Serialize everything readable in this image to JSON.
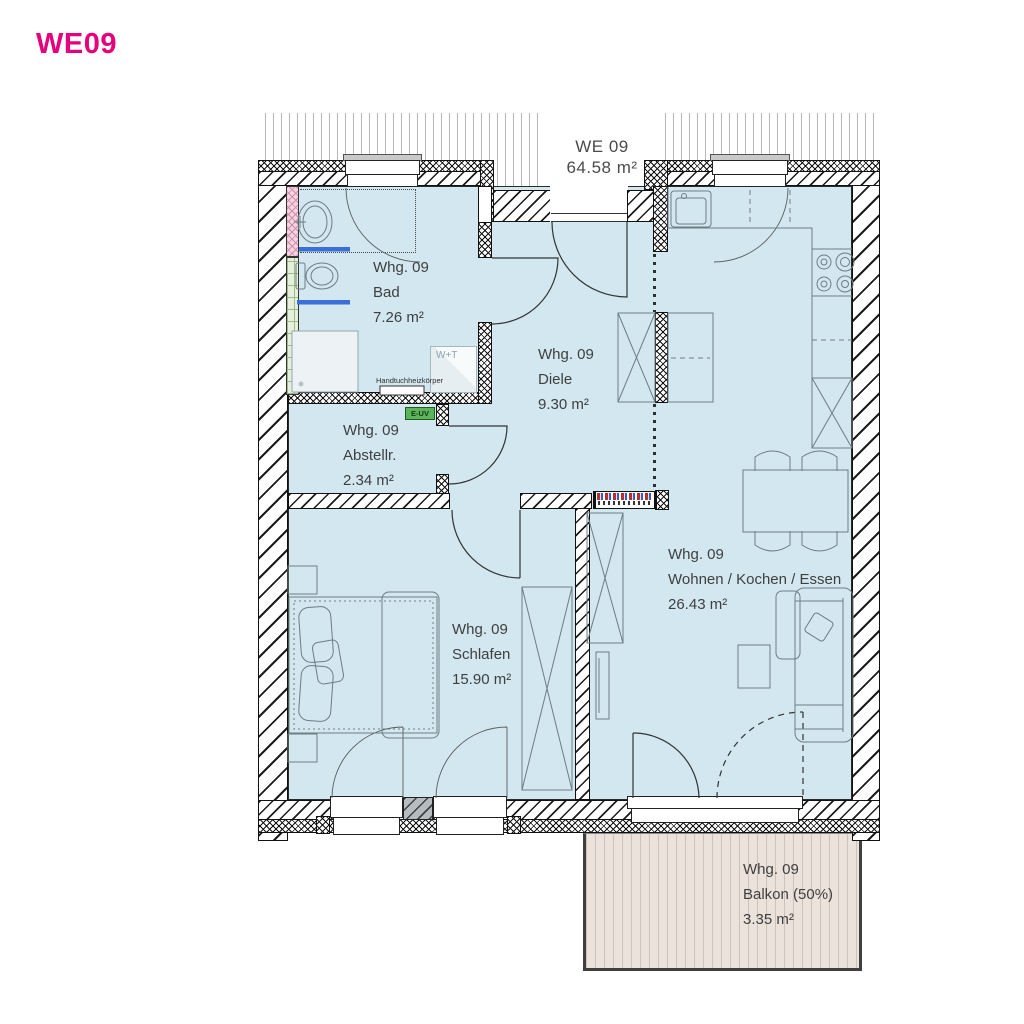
{
  "title": "WE09",
  "plan": {
    "header": {
      "unit": "WE 09",
      "area": "64.58 m²"
    },
    "rooms": [
      {
        "id": "bad",
        "unit": "Whg. 09",
        "name": "Bad",
        "area": "7.26 m²"
      },
      {
        "id": "diele",
        "unit": "Whg. 09",
        "name": "Diele",
        "area": "9.30 m²"
      },
      {
        "id": "abstellraum",
        "unit": "Whg. 09",
        "name": "Abstellr.",
        "area": "2.34 m²"
      },
      {
        "id": "schlafen",
        "unit": "Whg. 09",
        "name": "Schlafen",
        "area": "15.90 m²"
      },
      {
        "id": "wohnen",
        "unit": "Whg. 09",
        "name": "Wohnen / Kochen / Essen",
        "area": "26.43 m²"
      },
      {
        "id": "balkon",
        "unit": "Whg. 09",
        "name": "Balkon (50%)",
        "area": "3.35 m²"
      }
    ],
    "annotations": {
      "towel_radiator": "Handtuchheizkörper",
      "washer_dryer": "W+T",
      "electrical_box": "E-UV"
    }
  },
  "colors": {
    "accent_magenta": "#e6007e",
    "room_fill": "#d2e7ef",
    "balcony_fill": "#ebe2dc",
    "shaft_pink": "#f6d3e0",
    "tile_green": "#e4f0da",
    "radiator_blue": "#3a6fd8",
    "electrical_green": "#5cb35c",
    "wall_line": "#111111",
    "furniture_line": "#6e7c84",
    "text": "#3f3f3f"
  }
}
